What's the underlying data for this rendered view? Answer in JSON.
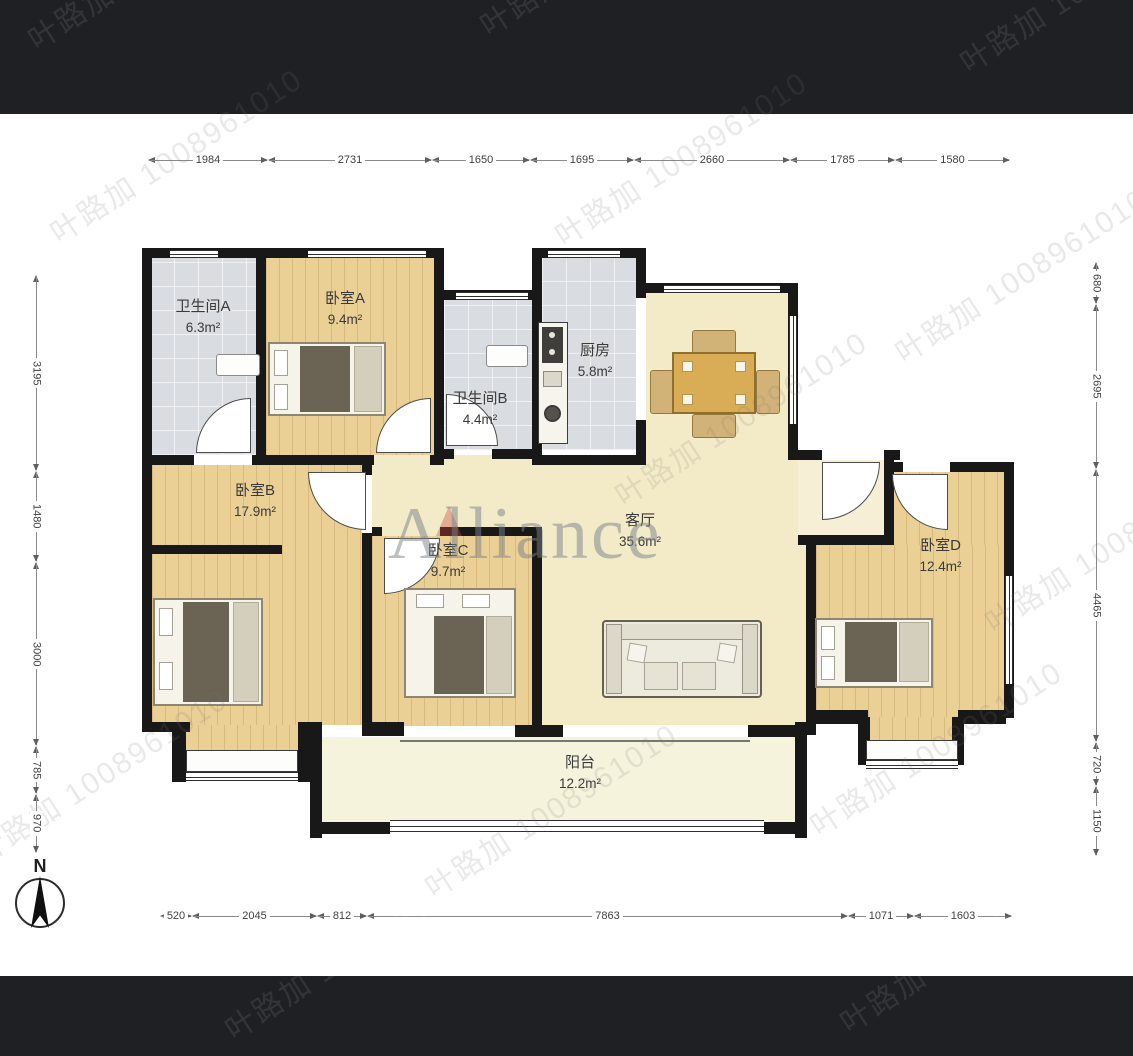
{
  "watermark": {
    "agent_text": "叶路加 1008961010",
    "brand": "Alliance"
  },
  "compass": {
    "label": "N"
  },
  "rooms": {
    "bathroom_a": {
      "name": "卫生间A",
      "area": "6.3m²"
    },
    "bedroom_a": {
      "name": "卧室A",
      "area": "9.4m²"
    },
    "bathroom_b": {
      "name": "卫生间B",
      "area": "4.4m²"
    },
    "kitchen": {
      "name": "厨房",
      "area": "5.8m²"
    },
    "bedroom_b": {
      "name": "卧室B",
      "area": "17.9m²"
    },
    "bedroom_c": {
      "name": "卧室C",
      "area": "9.7m²"
    },
    "living_room": {
      "name": "客厅",
      "area": "35.6m²"
    },
    "bedroom_d": {
      "name": "卧室D",
      "area": "12.4m²"
    },
    "balcony": {
      "name": "阳台",
      "area": "12.2m²"
    }
  },
  "dims": {
    "top": [
      "1984",
      "2731",
      "1650",
      "1695",
      "2660",
      "1785",
      "1580"
    ],
    "bottom": [
      "520",
      "2045",
      "812",
      "7863",
      "1071",
      "1603"
    ],
    "left": [
      "3195",
      "1480",
      "3000",
      "785",
      "970"
    ],
    "right": [
      "680",
      "2695",
      "4465",
      "720",
      "1150"
    ]
  },
  "colors": {
    "wall": "#181818",
    "bedroom_floor": "#ebd096",
    "wet_room_floor": "#d9dde1",
    "living_floor": "#f3ebc8",
    "balcony_floor": "#f6f3dd",
    "letterbox_band": "#1f2023"
  }
}
